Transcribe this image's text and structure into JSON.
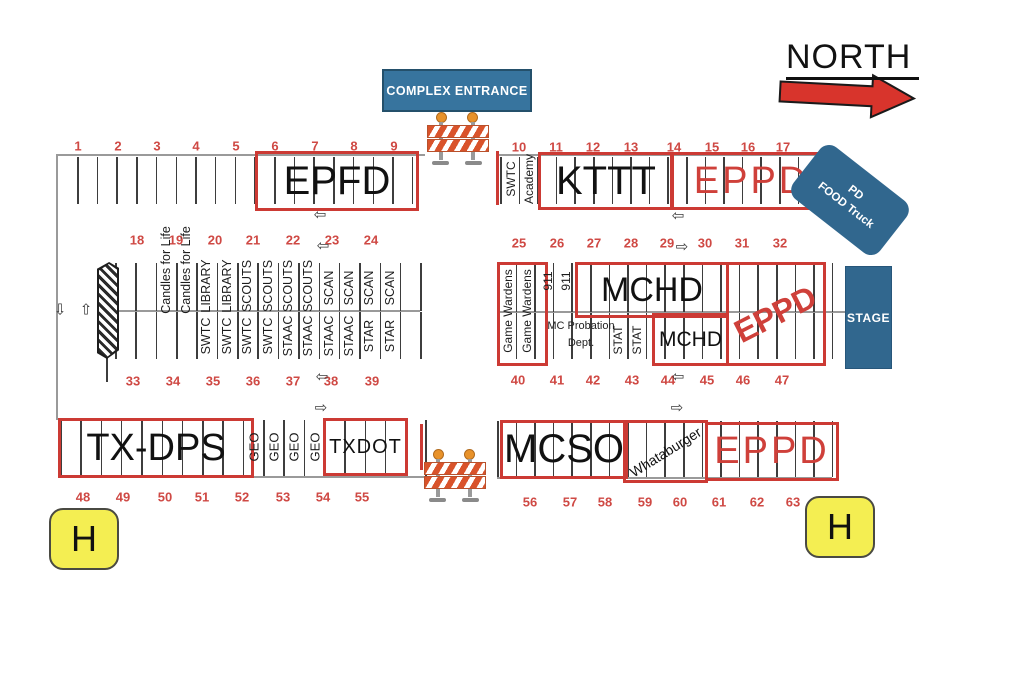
{
  "compass": {
    "label": "NORTH"
  },
  "entrance": {
    "label": "COMPLEX ENTRANCE"
  },
  "stage": {
    "label": "STAGE"
  },
  "food_truck": {
    "line1": "PD",
    "line2": "FOOD Truck"
  },
  "helipad": {
    "left": "H",
    "right": "H"
  },
  "colors": {
    "booth_outline_red": "#cc3a34",
    "number_red": "#cf4944",
    "sign_blue": "#37749e",
    "stage_blue": "#31678e",
    "north_arrow_red": "#d8342c",
    "helipad_yellow": "#f4ee52",
    "barricade_orange": "#d9532b"
  },
  "icons": {
    "arrow_left": "⇦",
    "arrow_right": "⇨",
    "arrow_up": "⇧",
    "arrow_down": "⇩"
  },
  "space_numbers": {
    "row1_left": [
      "1",
      "2",
      "3",
      "4",
      "5",
      "6",
      "7",
      "8",
      "9"
    ],
    "row1_right": [
      "10",
      "11",
      "12",
      "13",
      "14",
      "15",
      "16",
      "17"
    ],
    "row2_left": [
      "18",
      "19",
      "20",
      "21",
      "22",
      "23",
      "24"
    ],
    "row2_right": [
      "25",
      "26",
      "27",
      "28",
      "29",
      "30",
      "31",
      "32"
    ],
    "row3_left": [
      "33",
      "34",
      "35",
      "36",
      "37",
      "38",
      "39"
    ],
    "row3_right": [
      "40",
      "41",
      "42",
      "43",
      "44",
      "45",
      "46",
      "47"
    ],
    "row4_left": [
      "48",
      "49",
      "50",
      "51",
      "52",
      "53",
      "54",
      "55"
    ],
    "row4_right": [
      "56",
      "57",
      "58",
      "59",
      "60",
      "61",
      "62",
      "63"
    ]
  },
  "stall_labels": {
    "swtc_academy": [
      "SWTC",
      "Academy"
    ],
    "mid_left_top": [
      "Candles for Life",
      "Candles for Life",
      "LIBRARY",
      "LIBRARY",
      "SCOUTS",
      "SCOUTS",
      "SCOUTS",
      "SCOUTS",
      "SCAN",
      "SCAN",
      "SCAN",
      "SCAN"
    ],
    "mid_left_bottom": [
      "SWTC",
      "SWTC",
      "SWTC",
      "SWTC",
      "STAAC",
      "STAAC",
      "STAAC",
      "STAAC",
      "STAR",
      "STAR"
    ],
    "game_wardens": [
      "Game Wardens",
      "Game Wardens"
    ],
    "dispatch_911": [
      "911",
      "911"
    ],
    "stat": [
      "STAT",
      "STAT"
    ],
    "geo": [
      "GEO",
      "GEO",
      "GEO",
      "GEO"
    ]
  },
  "booths": {
    "epfd": "EPFD",
    "kttt": "KTTT",
    "eppd_north": "EPPD",
    "mchd_upper": "MCHD",
    "mchd_lower": "MCHD",
    "eppd_mid": "EPPD",
    "mc_probation": {
      "line1": "MC Probation",
      "line2": "Dept."
    },
    "tx_dps": "TX-DPS",
    "txdot": "TXDOT",
    "mcso": "MCSO",
    "whataburger": "Whataburger",
    "eppd_south": "EPPD"
  }
}
